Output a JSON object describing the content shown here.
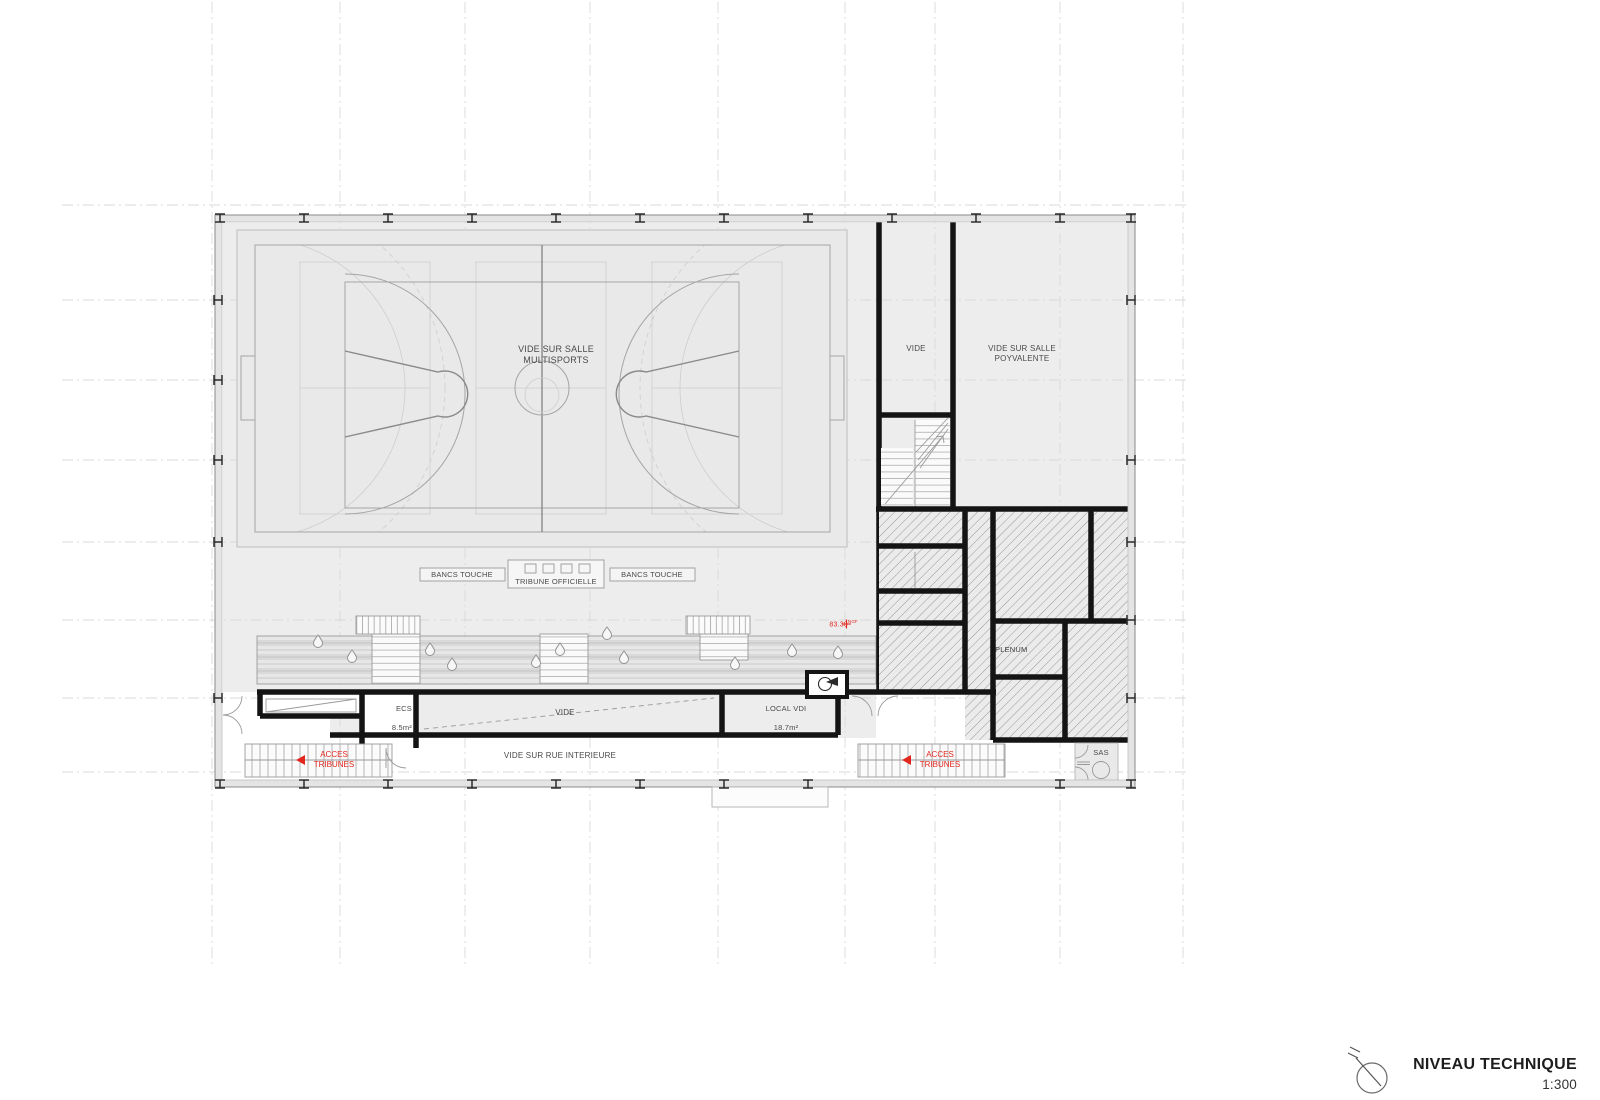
{
  "colors": {
    "accent_red": "#e2261d",
    "wall_black": "#141414",
    "fill_light": "#ededed"
  },
  "plan": {
    "court_label": "VIDE SUR SALLE MULTISPORTS",
    "shaft_label": "VIDE",
    "polyvalente_label": "VIDE SUR SALLE POYVALENTE",
    "bancs_touche": "BANCS TOUCHE",
    "tribune_officielle": "TRIBUNE OFFICIELLE",
    "ecs_name": "ECS",
    "ecs_area": "8.5m²",
    "vide_room": "VIDE",
    "local_vdi_name": "LOCAL VDI",
    "local_vdi_area": "18.7m²",
    "rue_label": "VIDE SUR RUE INTERIEURE",
    "acces_tribunes": "ACCES TRIBUNES",
    "plenum": "PLENUM",
    "sas": "SAS",
    "level_value": "83.30",
    "level_unit": "NGF"
  },
  "title_block": {
    "title": "NIVEAU TECHNIQUE",
    "scale": "1:300"
  }
}
